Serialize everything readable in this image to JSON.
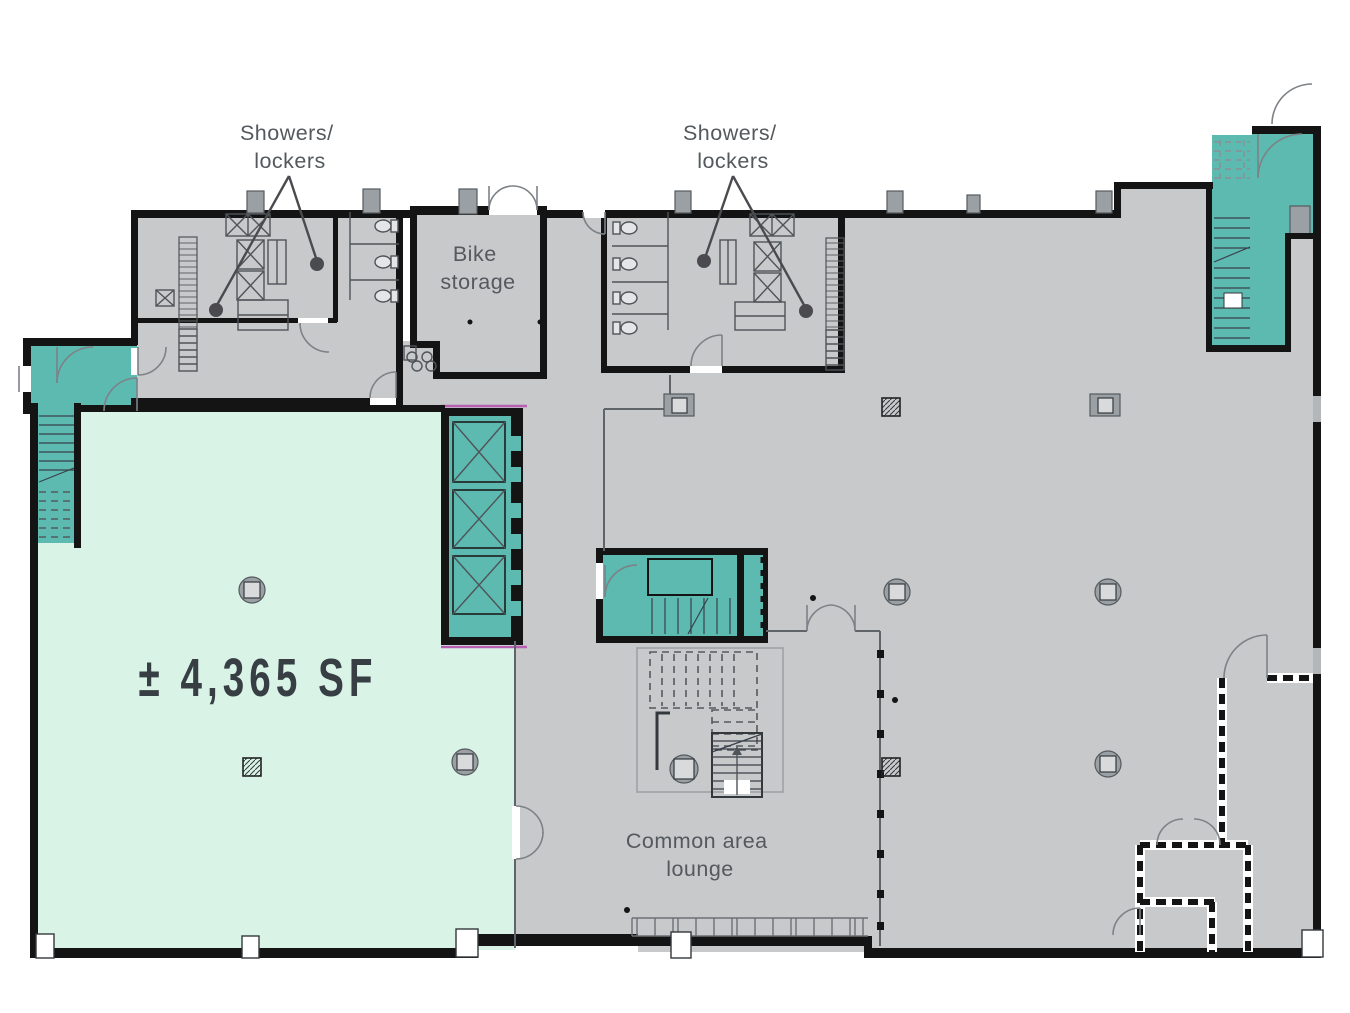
{
  "colors": {
    "mint": "#d9f4e6",
    "teal": "#5dbab1",
    "floor_gray": "#c8c9cb",
    "wall": "#141414",
    "label_text": "#54595d",
    "area_text": "#373e44",
    "leader": "#4a4a4f",
    "demising": "#b75fb3"
  },
  "labels": {
    "showers_lockers_west": {
      "line1": "Showers/",
      "line2": "lockers"
    },
    "showers_lockers_east": {
      "line1": "Showers/",
      "line2": "lockers"
    },
    "bike_storage": {
      "line1": "Bike",
      "line2": "storage"
    },
    "suite_area": "± 4,365 SF",
    "common_area": {
      "line1": "Common area",
      "line2": "lounge"
    }
  }
}
